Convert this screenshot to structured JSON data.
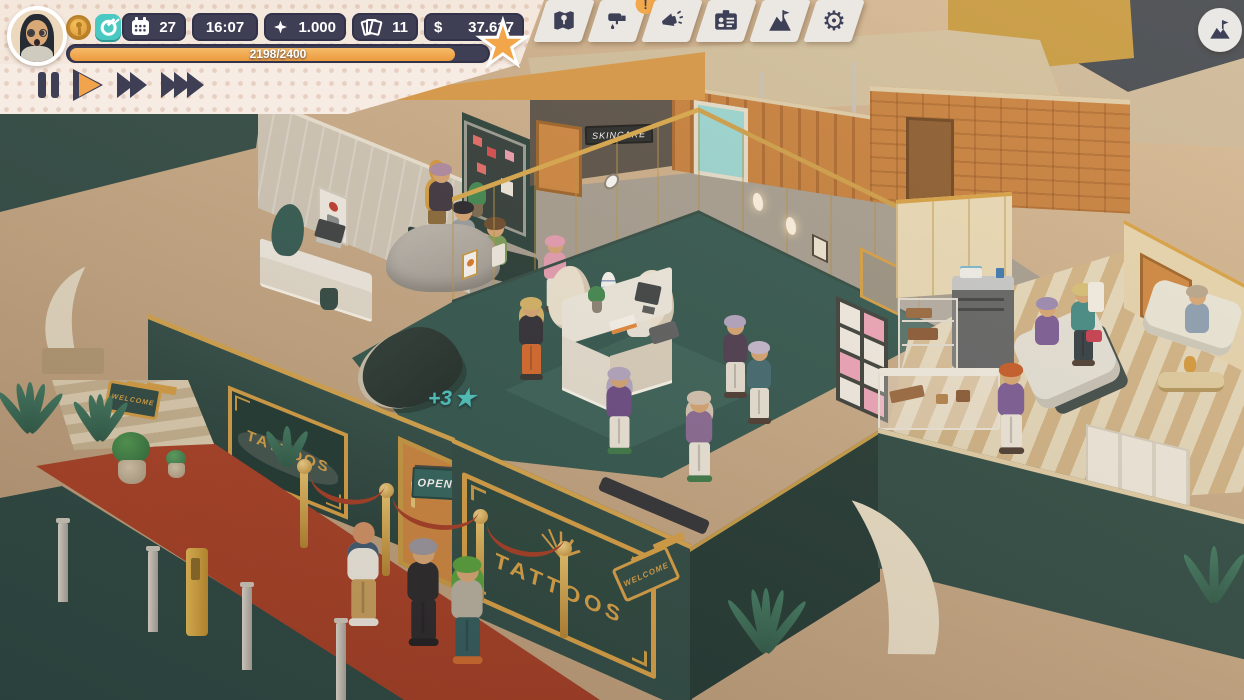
{
  "hud": {
    "avatar": "player-portrait-woman-glasses",
    "coin_icon": "gold-coin",
    "key_icon": "teal-key",
    "stats": {
      "day": "27",
      "time": "16:07",
      "energy": "1.000",
      "tickets": "11",
      "currency_symbol": "$",
      "money": "37.617"
    },
    "xp": {
      "text": "2198/2400",
      "fill": "91.6%",
      "star": "★"
    },
    "speed_controls": {
      "active": "play",
      "labels": [
        "pause",
        "play",
        "fast",
        "fastest"
      ]
    }
  },
  "toolbar": {
    "buttons": [
      {
        "id": "map",
        "icon": "map-icon",
        "badge": ""
      },
      {
        "id": "decorate",
        "icon": "paint-roller-icon",
        "badge": "!"
      },
      {
        "id": "marketing",
        "icon": "megaphone-icon",
        "badge": ""
      },
      {
        "id": "staff",
        "icon": "id-card-icon",
        "badge": ""
      },
      {
        "id": "goals",
        "icon": "mountain-flag-icon",
        "badge": ""
      },
      {
        "id": "settings",
        "icon": "gear-icon",
        "badge": ""
      }
    ],
    "gear_glyph": "⚙"
  },
  "minimap": {
    "icon": "mountain-flag-icon"
  },
  "scene": {
    "signs": {
      "tattoos_front": "TATTOOS",
      "tattoos_window": "TATTOOS",
      "open": "OPEN",
      "skincare": "SKINCARE",
      "welcome_left": "WELCOME",
      "welcome_right": "WELCOME"
    },
    "floating_bonus": {
      "value": "+3",
      "star": "★"
    },
    "colors": {
      "hud_pill": "#3e3e55",
      "hud_accent_orange": "#f2a44c",
      "hud_teal": "#49c9c1",
      "wall_dark_teal": "#2b4a46",
      "gold_trim": "#d9a246",
      "floor_teal": "#2e5651",
      "carpet_red": "#ad4026",
      "wall_orange": "#c8803e",
      "cream_wall": "#ece0c6"
    }
  }
}
